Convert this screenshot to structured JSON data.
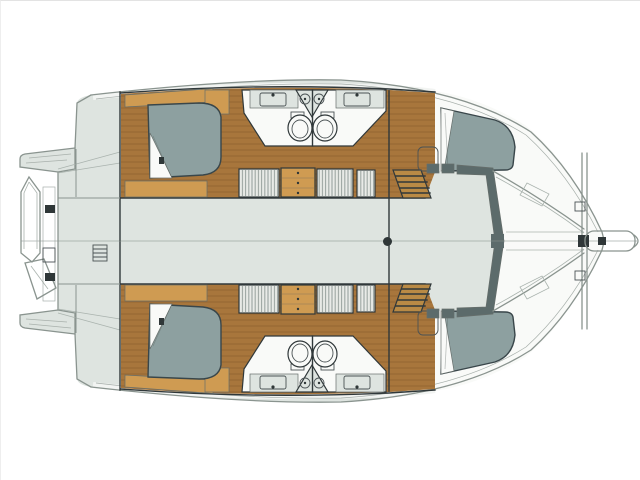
{
  "document": {
    "title": "Catamaran accommodation plan — overhead view",
    "type": "boat-floor-plan",
    "view": "top-down deck and cabin layout",
    "orientation": {
      "bow": "right",
      "stern": "left"
    }
  },
  "palette": {
    "page_bg": "#ffffff",
    "deck": "#dee4e0",
    "deck_line": "#8a948f",
    "wall_dark": "#30383a",
    "wood_floor": "#a8763c",
    "wood_plank_seam": "#7a5224",
    "wood_furniture": "#cf9b52",
    "wood_mid": "#b98a45",
    "fabric_gray": "#8da0a0",
    "fabric_outline": "#39464a",
    "white_surface": "#f9faf8",
    "trim_dark": "#5c6b6b",
    "louver_fill": "#e9ebe8",
    "louver_stripe": "#9aa4a0",
    "fitting_dark": "#2f3738"
  },
  "plan": {
    "hulls": [
      {
        "id": "hull-top",
        "rooms": [
          "aft-double-cabin",
          "aft-bathroom",
          "forward-bathroom",
          "wardrobes-and-drawers",
          "companionway-stairs",
          "forward-double-cabin",
          "bow-deck"
        ]
      },
      {
        "id": "hull-bottom",
        "rooms": [
          "aft-double-cabin",
          "aft-bathroom",
          "forward-bathroom",
          "wardrobes-and-drawers",
          "companionway-stairs",
          "forward-double-cabin",
          "bow-deck"
        ]
      }
    ],
    "deck_features": [
      "aft-cockpit",
      "swim-platform-steps",
      "dinghy-on-davits",
      "boarding-ladder",
      "bridgedeck-saloon",
      "mast-step",
      "windscreen-edge",
      "foredeck-trampoline",
      "forward-crossbeam",
      "bowsprit"
    ],
    "fixture_counts": {
      "double_beds": 4,
      "toilets": 4,
      "sinks": 4,
      "shower_trays": 4,
      "wardrobe_units": 6,
      "chests_of_drawers": 2
    }
  }
}
